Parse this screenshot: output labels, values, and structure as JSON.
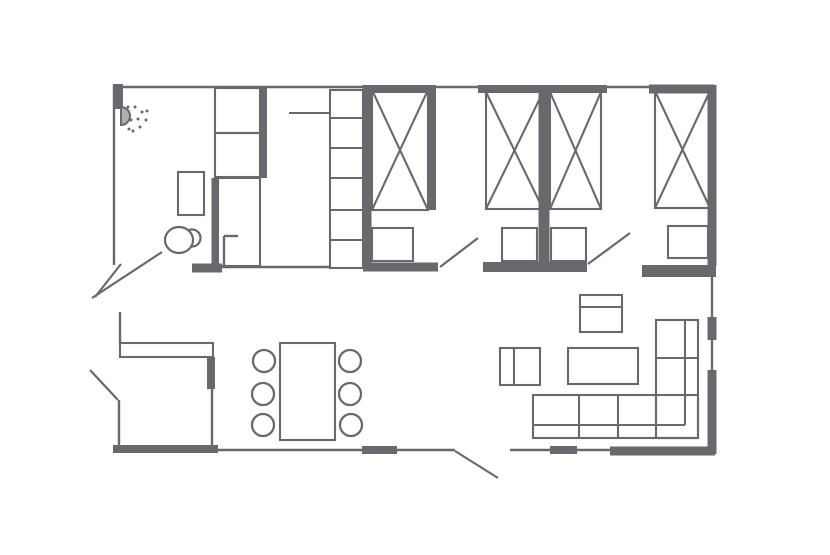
{
  "title": "apartment-floor-plan",
  "canvas": {
    "width": 830,
    "height": 555,
    "background": "#ffffff",
    "ink": "#67696c"
  },
  "walls": {
    "thin_width": 2.4,
    "thick": [
      {
        "name": "top-left-corner-post",
        "x1": 118,
        "y1": 84,
        "x2": 118,
        "y2": 109,
        "w": 10
      },
      {
        "name": "top-wall-seg-bed1",
        "x1": 363,
        "y1": 89,
        "x2": 436,
        "y2": 89,
        "w": 8
      },
      {
        "name": "top-wall-seg-bed2-3",
        "x1": 478,
        "y1": 89,
        "x2": 607,
        "y2": 89,
        "w": 8
      },
      {
        "name": "top-wall-seg-bed4",
        "x1": 649,
        "y1": 89,
        "x2": 714,
        "y2": 89,
        "w": 9
      },
      {
        "name": "bedroom3-right-wall",
        "x1": 712,
        "y1": 85,
        "x2": 712,
        "y2": 266,
        "w": 9
      },
      {
        "name": "closet-wall-vertical",
        "x1": 263,
        "y1": 86,
        "x2": 263,
        "y2": 178,
        "w": 8
      },
      {
        "name": "hall-closet-wall-vertical",
        "x1": 215,
        "y1": 178,
        "x2": 215,
        "y2": 266,
        "w": 7
      },
      {
        "name": "bathroom-bottom-wall",
        "x1": 192,
        "y1": 268,
        "x2": 222,
        "y2": 268,
        "w": 9
      },
      {
        "name": "bedroom1-left-wall",
        "x1": 367,
        "y1": 85,
        "x2": 367,
        "y2": 263,
        "w": 9
      },
      {
        "name": "bedroom1-right-wall",
        "x1": 432,
        "y1": 85,
        "x2": 432,
        "y2": 210,
        "w": 8
      },
      {
        "name": "bedroom2-bedroom3-wall",
        "x1": 544,
        "y1": 87,
        "x2": 544,
        "y2": 263,
        "w": 11
      },
      {
        "name": "bedroom1-bottom-wall",
        "x1": 363,
        "y1": 267,
        "x2": 438,
        "y2": 267,
        "w": 9
      },
      {
        "name": "bedroom2-bottom-wall",
        "x1": 483,
        "y1": 267,
        "x2": 587,
        "y2": 267,
        "w": 10
      },
      {
        "name": "livingroom-top-wall",
        "x1": 642,
        "y1": 271,
        "x2": 716,
        "y2": 271,
        "w": 12
      },
      {
        "name": "kitchen-wall-post",
        "x1": 211,
        "y1": 357,
        "x2": 211,
        "y2": 389,
        "w": 8
      },
      {
        "name": "bottom-wall-seg-left",
        "x1": 113,
        "y1": 449,
        "x2": 218,
        "y2": 449,
        "w": 8
      },
      {
        "name": "bottom-wall-seg-mid1",
        "x1": 362,
        "y1": 450,
        "x2": 397,
        "y2": 450,
        "w": 8
      },
      {
        "name": "bottom-wall-seg-mid2",
        "x1": 550,
        "y1": 450,
        "x2": 577,
        "y2": 450,
        "w": 8
      },
      {
        "name": "bottom-wall-seg-right",
        "x1": 610,
        "y1": 451,
        "x2": 715,
        "y2": 451,
        "w": 9
      },
      {
        "name": "right-wall-seg-mid",
        "x1": 712,
        "y1": 317,
        "x2": 712,
        "y2": 340,
        "w": 9
      },
      {
        "name": "right-wall-seg-low",
        "x1": 712,
        "y1": 370,
        "x2": 712,
        "y2": 454,
        "w": 9
      }
    ],
    "thin": [
      {
        "name": "top-wall",
        "x1": 113,
        "y1": 87,
        "x2": 716,
        "y2": 87
      },
      {
        "name": "left-wall-bathroom",
        "x1": 114,
        "y1": 85,
        "x2": 114,
        "y2": 265
      },
      {
        "name": "left-wall-kitchen",
        "x1": 120,
        "y1": 312,
        "x2": 120,
        "y2": 344
      },
      {
        "name": "left-wall-entry",
        "x1": 119,
        "y1": 400,
        "x2": 119,
        "y2": 450
      },
      {
        "name": "bottom-wall-window-a",
        "x1": 216,
        "y1": 450,
        "x2": 364,
        "y2": 450
      },
      {
        "name": "bottom-wall-window-b",
        "x1": 396,
        "y1": 450,
        "x2": 455,
        "y2": 450
      },
      {
        "name": "bottom-wall-window-c",
        "x1": 510,
        "y1": 450,
        "x2": 553,
        "y2": 450
      },
      {
        "name": "bottom-wall-window-d",
        "x1": 576,
        "y1": 450,
        "x2": 612,
        "y2": 450
      },
      {
        "name": "right-wall-window-upper",
        "x1": 712,
        "y1": 277,
        "x2": 712,
        "y2": 318
      },
      {
        "name": "right-wall-window-lower",
        "x1": 712,
        "y1": 339,
        "x2": 712,
        "y2": 371
      },
      {
        "name": "hall-bottom-wall",
        "x1": 218,
        "y1": 267,
        "x2": 331,
        "y2": 267
      },
      {
        "name": "kitchen-wall-lower",
        "x1": 212,
        "y1": 388,
        "x2": 212,
        "y2": 450
      },
      {
        "name": "toilet-partition-vertical",
        "x1": 224,
        "y1": 236,
        "x2": 224,
        "y2": 266
      },
      {
        "name": "toilet-partition-horizontal",
        "x1": 224,
        "y1": 236,
        "x2": 238,
        "y2": 236
      }
    ]
  },
  "doors": {
    "width": 2.2,
    "leaves": [
      {
        "name": "bedroom2-door-swing",
        "x1": 440,
        "y1": 267,
        "x2": 478,
        "y2": 238
      },
      {
        "name": "bedroom3-door-swing",
        "x1": 588,
        "y1": 264,
        "x2": 630,
        "y2": 233
      },
      {
        "name": "entry-door-swing-a",
        "x1": 162,
        "y1": 252,
        "x2": 92,
        "y2": 298
      },
      {
        "name": "entry-door-swing-b",
        "x1": 121,
        "y1": 264,
        "x2": 95,
        "y2": 297
      },
      {
        "name": "side-door-swing",
        "x1": 90,
        "y1": 370,
        "x2": 118,
        "y2": 400
      },
      {
        "name": "terrace-door-swing",
        "x1": 455,
        "y1": 451,
        "x2": 498,
        "y2": 478
      }
    ]
  },
  "furniture": {
    "stroke_width": 2.1,
    "beds": [
      {
        "name": "bed-1",
        "x": 372,
        "y": 90,
        "w": 56,
        "h": 120
      },
      {
        "name": "bed-2",
        "x": 486,
        "y": 92,
        "w": 57,
        "h": 117
      },
      {
        "name": "bed-3",
        "x": 550,
        "y": 92,
        "w": 51,
        "h": 117
      },
      {
        "name": "bed-4",
        "x": 655,
        "y": 91,
        "w": 55,
        "h": 117
      }
    ],
    "rects": [
      {
        "name": "closet-upper-shelf",
        "x": 215,
        "y": 88,
        "w": 45,
        "h": 45
      },
      {
        "name": "closet-lower-shelf",
        "x": 215,
        "y": 133,
        "w": 45,
        "h": 44
      },
      {
        "name": "hall-closet",
        "x": 218,
        "y": 178,
        "w": 42,
        "h": 88
      },
      {
        "name": "wardrobe-shelving",
        "x": 330,
        "y": 90,
        "w": 33,
        "h": 178
      },
      {
        "name": "bathroom-sink",
        "x": 178,
        "y": 172,
        "w": 26,
        "h": 43
      },
      {
        "name": "nightstand-1",
        "x": 372,
        "y": 228,
        "w": 41,
        "h": 33
      },
      {
        "name": "nightstand-2",
        "x": 502,
        "y": 228,
        "w": 35,
        "h": 33
      },
      {
        "name": "nightstand-3",
        "x": 551,
        "y": 228,
        "w": 35,
        "h": 33
      },
      {
        "name": "nightstand-4",
        "x": 668,
        "y": 226,
        "w": 40,
        "h": 32
      },
      {
        "name": "kitchen-counter",
        "x": 120,
        "y": 343,
        "w": 93,
        "h": 14
      },
      {
        "name": "dining-table",
        "x": 280,
        "y": 343,
        "w": 55,
        "h": 97
      },
      {
        "name": "tv-cabinet",
        "x": 580,
        "y": 295,
        "w": 42,
        "h": 37
      },
      {
        "name": "armchair",
        "x": 500,
        "y": 348,
        "w": 40,
        "h": 37
      },
      {
        "name": "coffee-table",
        "x": 568,
        "y": 348,
        "w": 70,
        "h": 36
      },
      {
        "name": "sofa-long-section",
        "x": 533,
        "y": 395,
        "w": 165,
        "h": 43
      },
      {
        "name": "sofa-short-section",
        "x": 656,
        "y": 320,
        "w": 42,
        "h": 118
      }
    ],
    "lines": [
      {
        "name": "wardrobe-shelf-1",
        "x1": 330,
        "y1": 118,
        "x2": 363,
        "y2": 118
      },
      {
        "name": "wardrobe-shelf-2",
        "x1": 330,
        "y1": 148,
        "x2": 363,
        "y2": 148
      },
      {
        "name": "wardrobe-shelf-3",
        "x1": 330,
        "y1": 178,
        "x2": 363,
        "y2": 178
      },
      {
        "name": "wardrobe-shelf-4",
        "x1": 330,
        "y1": 210,
        "x2": 363,
        "y2": 210
      },
      {
        "name": "wardrobe-shelf-5",
        "x1": 330,
        "y1": 240,
        "x2": 363,
        "y2": 240
      },
      {
        "name": "wardrobe-rod",
        "x1": 289,
        "y1": 113,
        "x2": 330,
        "y2": 113
      },
      {
        "name": "tv-cabinet-divider",
        "x1": 580,
        "y1": 307,
        "x2": 622,
        "y2": 307
      },
      {
        "name": "armchair-divider",
        "x1": 514,
        "y1": 348,
        "x2": 514,
        "y2": 385
      },
      {
        "name": "sofa-backrest-horizontal",
        "x1": 533,
        "y1": 425,
        "x2": 685,
        "y2": 425
      },
      {
        "name": "sofa-seat-divider-1",
        "x1": 579,
        "y1": 395,
        "x2": 579,
        "y2": 438
      },
      {
        "name": "sofa-seat-divider-2",
        "x1": 618,
        "y1": 395,
        "x2": 618,
        "y2": 438
      },
      {
        "name": "sofa-corner-seam",
        "x1": 656,
        "y1": 395,
        "x2": 656,
        "y2": 438
      },
      {
        "name": "sofa-backrest-vertical",
        "x1": 685,
        "y1": 320,
        "x2": 685,
        "y2": 425
      },
      {
        "name": "sofa-seat-divider-3",
        "x1": 656,
        "y1": 358,
        "x2": 698,
        "y2": 358
      }
    ],
    "circles": [
      {
        "name": "dining-chair-1",
        "cx": 264,
        "cy": 361,
        "r": 11
      },
      {
        "name": "dining-chair-2",
        "cx": 263,
        "cy": 394,
        "r": 11
      },
      {
        "name": "dining-chair-3",
        "cx": 263,
        "cy": 425,
        "r": 11
      },
      {
        "name": "dining-chair-4",
        "cx": 350,
        "cy": 361,
        "r": 11
      },
      {
        "name": "dining-chair-5",
        "cx": 350,
        "cy": 394,
        "r": 11
      },
      {
        "name": "dining-chair-6",
        "cx": 351,
        "cy": 425,
        "r": 11
      },
      {
        "name": "toilet-tank",
        "cx": 192,
        "cy": 238,
        "r": 8.5
      }
    ],
    "ellipses": [
      {
        "name": "toilet-bowl",
        "cx": 179,
        "cy": 240,
        "rx": 14,
        "ry": 13
      }
    ]
  },
  "shower": {
    "cx": 121,
    "cy": 116,
    "r": 9,
    "dot_radius": 1.5,
    "dots": [
      [
        135,
        107
      ],
      [
        142,
        112
      ],
      [
        146,
        120
      ],
      [
        140,
        127
      ],
      [
        133,
        131
      ],
      [
        131,
        120
      ],
      [
        138,
        119
      ],
      [
        128,
        107
      ],
      [
        147,
        111
      ],
      [
        129,
        129
      ]
    ]
  }
}
